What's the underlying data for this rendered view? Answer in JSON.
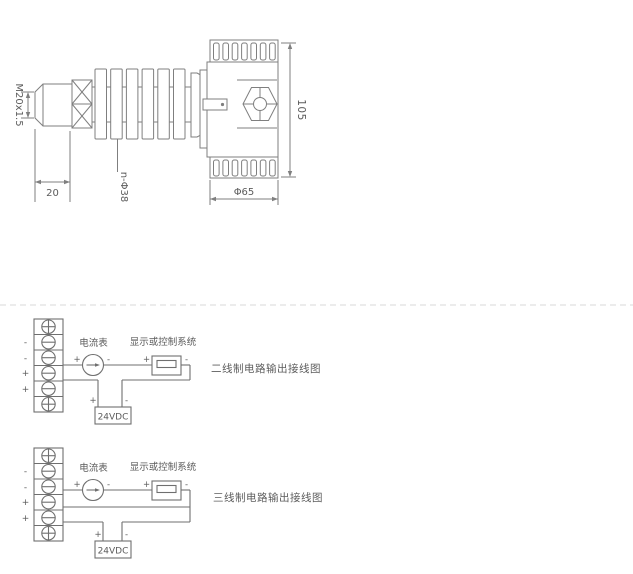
{
  "colors": {
    "background": "#ffffff",
    "drawing_line": "#7f7f7f",
    "wiring_line": "#6f6f6f",
    "text": "#5c5c5c",
    "divider": "#d9d9d9"
  },
  "mechanical_drawing": {
    "thread_label": "M20x1.5",
    "thread_length_dim": "20",
    "fin_diameter_dim": "n-Φ38",
    "housing_diameter_dim": "Φ65",
    "housing_height_dim": "105"
  },
  "wiring": {
    "ammeter_label": "电流表",
    "display_label": "显示或控制系统",
    "power_label": "24VDC",
    "plus": "+",
    "minus": "-",
    "diagrams": [
      {
        "title": "二线制电路输出接线图",
        "terminal_labels": [
          "-",
          "-",
          "+",
          "+"
        ]
      },
      {
        "title": "三线制电路输出接线图",
        "terminal_labels": [
          "-",
          "-",
          "+",
          "+"
        ]
      }
    ]
  }
}
